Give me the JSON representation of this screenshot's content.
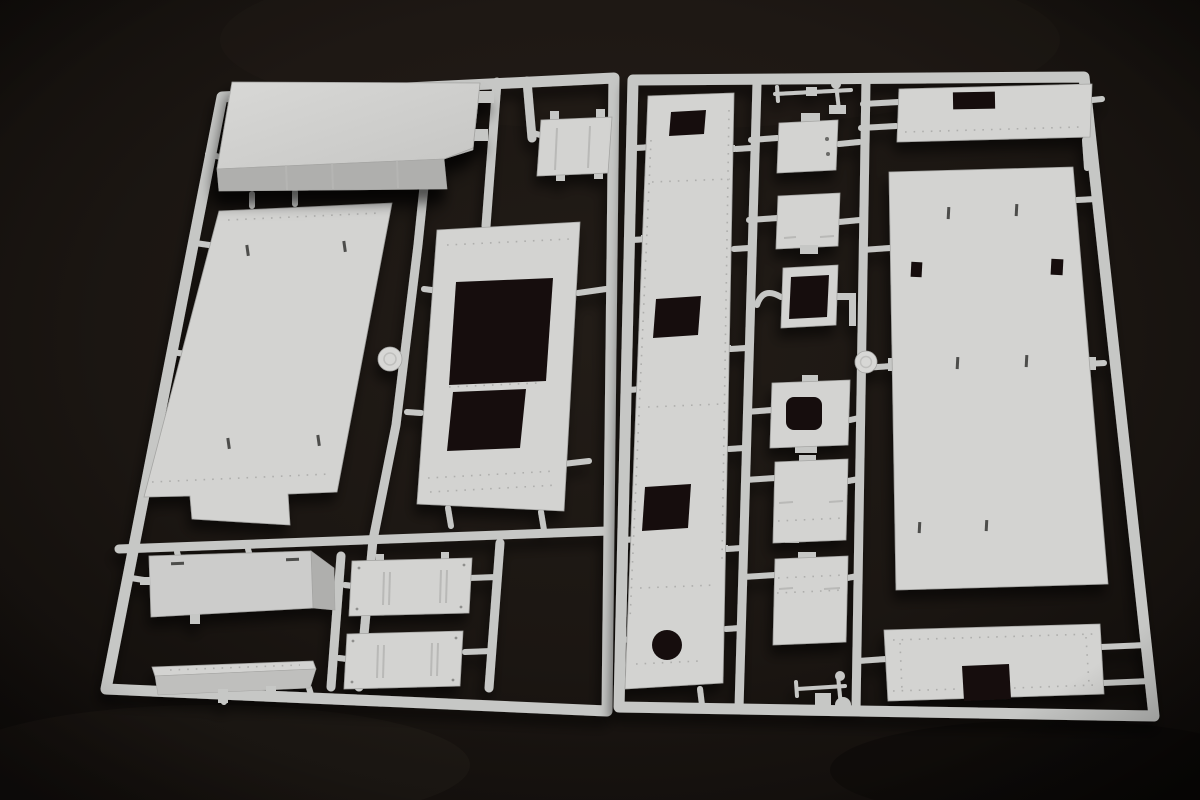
{
  "scene": {
    "description": "Product photograph of two light-grey injection-molded plastic model kit sprues on a dark near-black studio background, viewed at a slight top-down perspective angle.",
    "objects": {
      "left_sprue": {
        "label": "left sprue frame",
        "parts": [
          "raised-hull-box-part",
          "large-deck-panel",
          "small-hatch-plate",
          "double-opening-panel",
          "ribbed-plate-upper",
          "ribbed-plate-lower",
          "side-box-part",
          "thin-angled-strip"
        ]
      },
      "right_sprue": {
        "label": "right sprue frame",
        "parts": [
          "long-hull-side-strip",
          "pipe-fitting-top",
          "notched-hatch-plate",
          "square-hatch-plate",
          "square-ring-frame",
          "rounded-hole-plate",
          "detail-plate-upper",
          "detail-plate-lower",
          "pipe-fitting-bottom",
          "top-right-panel",
          "large-roof-panel",
          "bottom-notched-panel"
        ]
      },
      "molding_marks": [
        "ejector-disc-left",
        "ejector-disc-right"
      ]
    }
  },
  "colors": {
    "bg0": "#0e0b09",
    "bg1": "#221c17",
    "bg2": "#2d2620",
    "plastic": "#d3d3d1",
    "plastic2": "#cccccb",
    "runner": "#c6c7c5",
    "shade": "#afafad",
    "shade2": "#bfbfbd",
    "boxtop": "#cfcfcd",
    "hole": "#161110",
    "slit": "#4d4d4b",
    "edge": "#a5a5a3",
    "disc": "#d7d7d5",
    "rivet": "#90908e",
    "score": "#b6b6b4"
  }
}
